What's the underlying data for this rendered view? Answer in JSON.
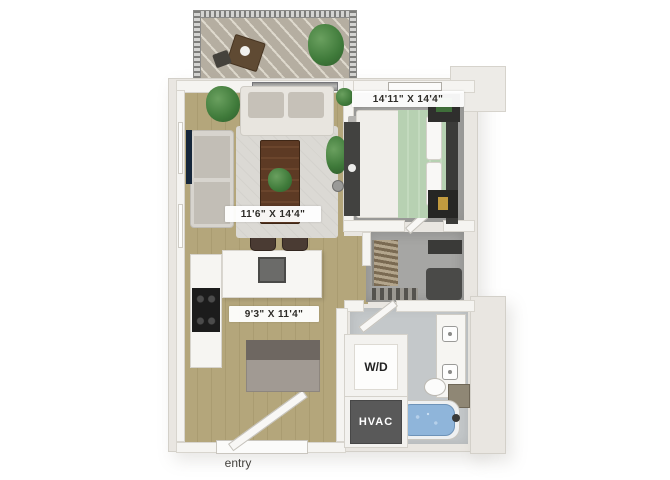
{
  "floorplan": {
    "labels": {
      "bedroom_dimensions": "14'11\" X 14'4\"",
      "living_dimensions": "11'6\" X 14'4\"",
      "kitchen_dimensions": "9'3\" X 11'4\"",
      "washer_dryer": "W/D",
      "hvac": "HVAC",
      "entry": "entry"
    },
    "colors": {
      "wood_floor": "#b0a276",
      "bedroom_carpet": "#a0a09e",
      "bathroom_floor": "#c4c8ca",
      "wall": "#f5f4f1",
      "building_shell": "#e9e6e1",
      "hvac_dark": "#595959",
      "tub_water": "#8fb5da",
      "plant_green": "#3f7a3a",
      "label_background": "#ffffff",
      "label_text": "#2e2c28"
    }
  }
}
